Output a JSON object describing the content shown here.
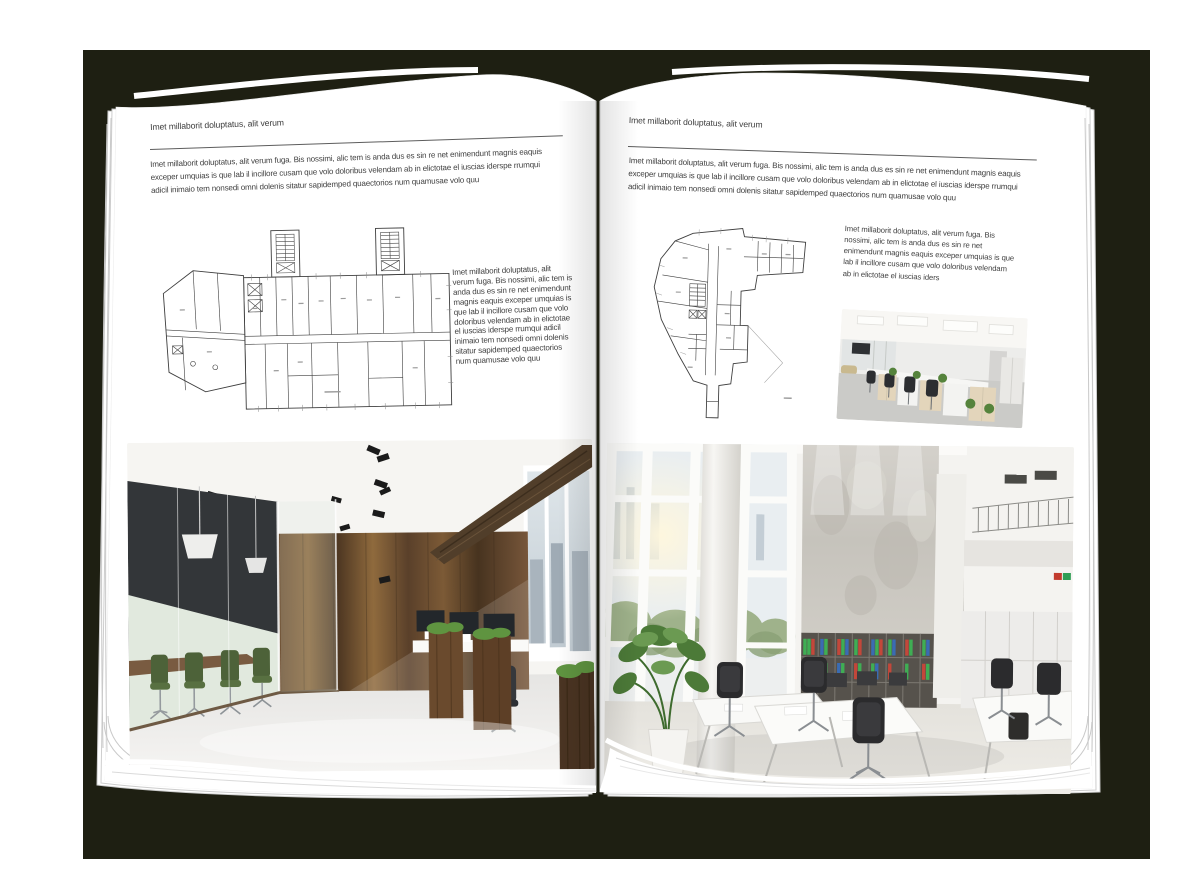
{
  "colors": {
    "backdrop": "#1e1f12",
    "page": "#ffffff",
    "ink": "#404040",
    "rule": "#5d5d5d",
    "wood_accent": "#7c5a36",
    "chair_green": "#44612f",
    "binder_green": "#3fae54",
    "binder_red": "#c3473a",
    "binder_blue": "#3a6cb3"
  },
  "spread": {
    "left_page": {
      "header": "Imet millaborit doluptatus, alit verum",
      "intro": "Imet millaborit doluptatus, alit verum fuga. Bis nossimi, alic tem is anda dus es sin re net enimendunt magnis eaquis exceper umquias is que lab il incillore cusam que volo doloribus velendam ab in elictotae el iuscias iderspe rrumqui adicil inimaio tem nonsedi omni dolenis sitatur sapidemped quaectorios num quamusae volo quu",
      "side_text": "Imet millaborit doluptatus, alit verum fuga. Bis nossimi, alic tem is anda dus es sin re net enimendunt magnis eaquis exceper umquias is que lab il incillore cusam que volo doloribus velendam ab in elictotae el iuscias iderspe rrumqui adicil inimaio tem nonsedi omni dolenis sitatur sapidemped quaectorios num quamusae volo quu"
    },
    "right_page": {
      "header": "Imet millaborit doluptatus, alit verum",
      "intro": "Imet millaborit doluptatus, alit verum fuga. Bis nossimi, alic tem is anda dus es sin re net enimendunt magnis eaquis exceper umquias is que lab il incillore cusam que volo doloribus velendam ab in elictotae el iuscias iderspe rrumqui adicil inimaio tem nonsedi omni dolenis sitatur sapidemped quaectorios num quamusae volo quu",
      "side_text": "Imet millaborit doluptatus, alit verum fuga. Bis nossimi, alic tem is anda dus es sin re net enimendunt magnis eaquis exceper umquias is que lab il incillore cusam que volo doloribus velendam ab in elictotae el iuscias iders"
    }
  },
  "images": {
    "left_floorplan": "architectural-floor-plan-wide-building",
    "right_floorplan": "architectural-floor-plan-irregular-building",
    "left_photo": "loft-office-interior-photo",
    "right_small_photo": "open-office-workstations-photo",
    "right_photo": "bright-double-height-office-photo"
  }
}
